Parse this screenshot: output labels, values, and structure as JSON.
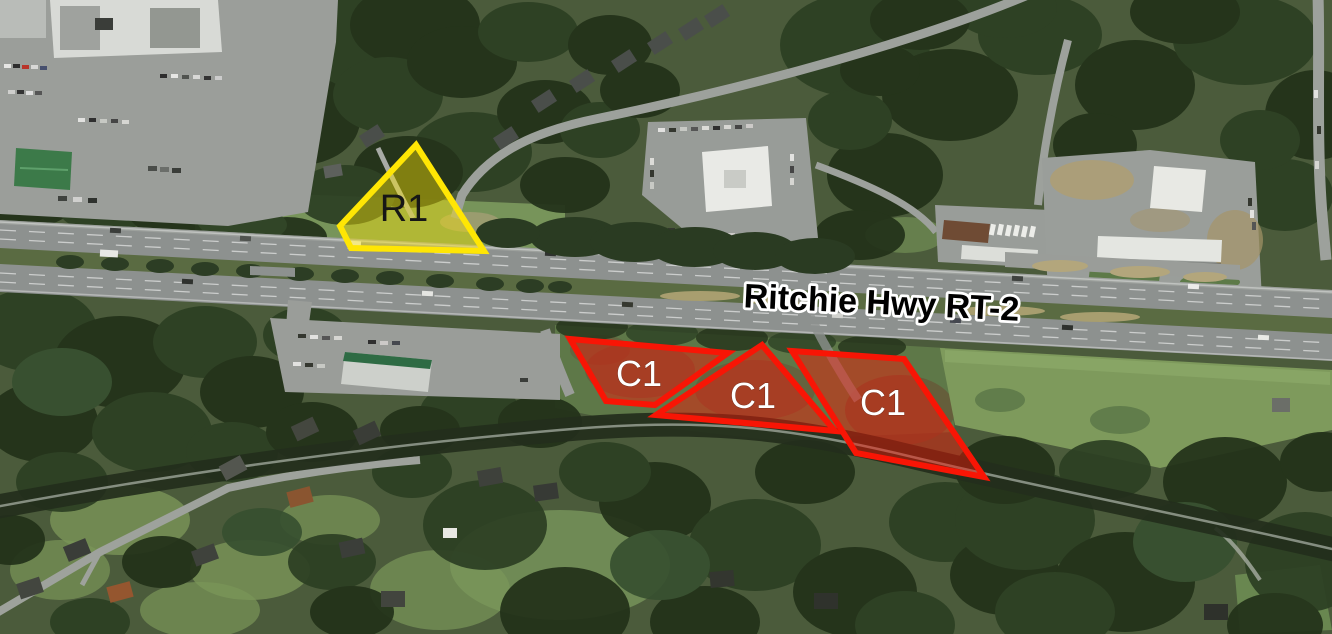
{
  "map": {
    "title": "Aerial zoning overlay map",
    "road_label": {
      "text": "Ritchie Hwy RT-2",
      "x": "881",
      "y": "314",
      "rotation_deg": 2.8
    },
    "zones": [
      {
        "label": "R1",
        "stroke": "#ffe604",
        "fill": "#ffe604",
        "fill_opacity": "0.42",
        "stroke_width": "6",
        "points": "416,145 340,226 351,248 484,251",
        "label_x": "404",
        "label_y": "221",
        "label_color": "#161616"
      },
      {
        "label": "C1",
        "stroke": "#f81505",
        "fill": "#f81505",
        "fill_opacity": "0.45",
        "stroke_width": "6",
        "points": "570,339 728,353 655,405 606,401",
        "label_x": "639",
        "label_y": "386",
        "label_color": "#ffffff"
      },
      {
        "label": "C1",
        "stroke": "#f81505",
        "fill": "#f81505",
        "fill_opacity": "0.45",
        "stroke_width": "6",
        "points": "762,345 656,415 835,431",
        "label_x": "753",
        "label_y": "408",
        "label_color": "#ffffff"
      },
      {
        "label": "C1",
        "stroke": "#f81505",
        "fill": "#f81505",
        "fill_opacity": "0.45",
        "stroke_width": "6",
        "points": "792,351 904,359 984,477 856,453",
        "label_x": "883",
        "label_y": "415",
        "label_color": "#ffffff"
      }
    ]
  }
}
